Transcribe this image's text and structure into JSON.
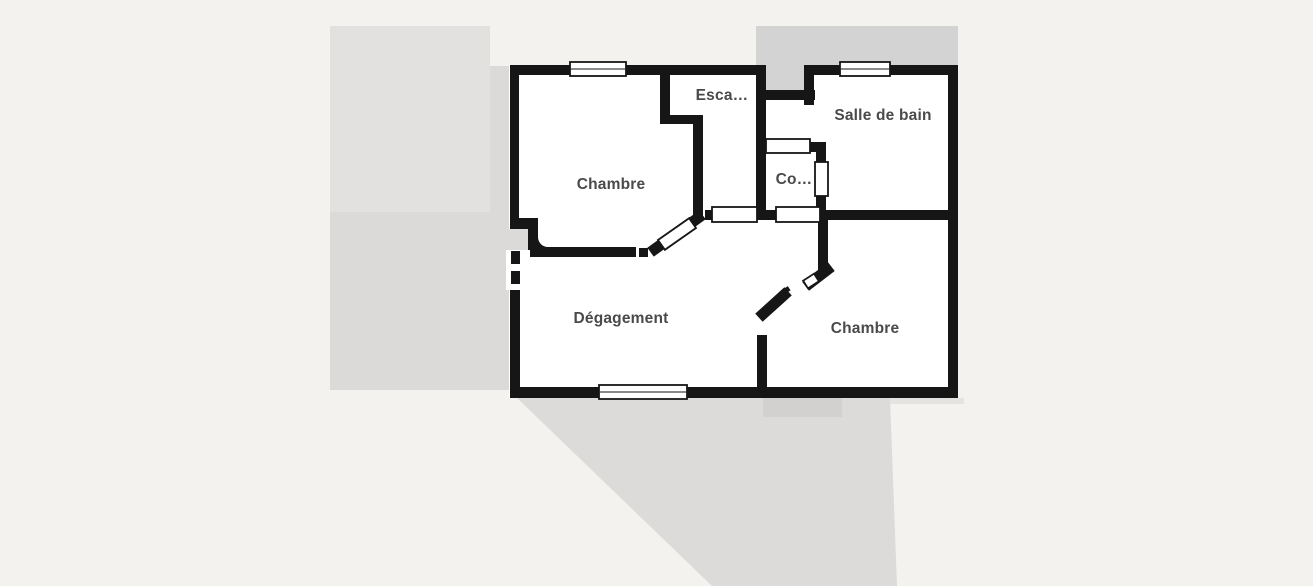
{
  "floor_plan": {
    "rooms": [
      {
        "id": "chambre-1",
        "label": "Chambre"
      },
      {
        "id": "escalier",
        "label": "Esca…"
      },
      {
        "id": "salle-de-bain",
        "label": "Salle de bain"
      },
      {
        "id": "co",
        "label": "Co…"
      },
      {
        "id": "degagement",
        "label": "Dégagement"
      },
      {
        "id": "chambre-2",
        "label": "Chambre"
      }
    ],
    "colors": {
      "wall": "#161616",
      "room_fill": "#ffffff",
      "page_background": "#f4f2ef",
      "label_text": "#4a4a4a",
      "shadow_left_upper": "#e2e1e0",
      "shadow_left_lower": "#dbdad9",
      "shadow_top": "#d3d3d3",
      "shadow_bottom": "#dcdbda",
      "shadow_bottom_dark": "#d2d1d0",
      "shadow_edge": "#e4e3e1"
    }
  }
}
